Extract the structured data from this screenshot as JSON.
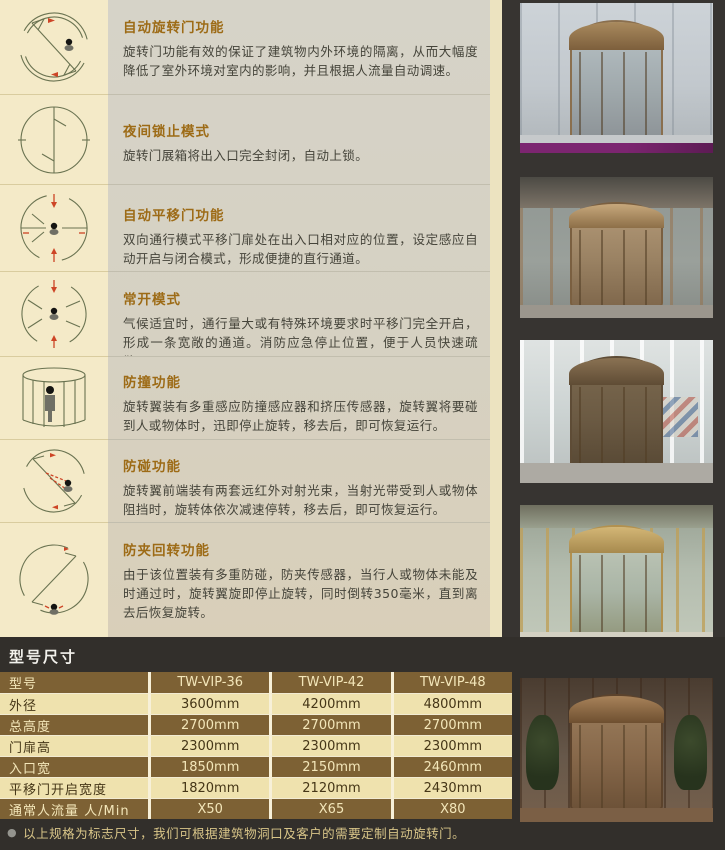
{
  "sections": [
    {
      "title": "自动旋转门功能",
      "body": "旋转门功能有效的保证了建筑物内外环境的隔离，从而大幅度降低了室外环境对室内的影响，并且根据人流量自动调速。",
      "diagram": "auto-revolving-top-view"
    },
    {
      "title": "夜间锁止模式",
      "body": "旋转门展箱将出入口完全封闭，自动上锁。",
      "diagram": "night-lock-top-view"
    },
    {
      "title": "自动平移门功能",
      "body": "双向通行模式平移门扉处在出入口相对应的位置，设定感应自动开启与闭合模式，形成便捷的直行通道。",
      "diagram": "auto-sliding-top-view"
    },
    {
      "title": "常开模式",
      "body": "气候适宜时，通行量大或有特殊环境要求时平移门完全开启，形成一条宽敞的通道。消防应急停止位置，便于人员快速疏散。",
      "diagram": "always-open-top-view"
    },
    {
      "title": "防撞功能",
      "body": "旋转翼装有多重感应防撞感应器和挤压传感器，旋转翼将要碰到人或物体时，迅即停止旋转，移去后，即可恢复运行。",
      "diagram": "anti-collision-elevation-view"
    },
    {
      "title": "防碰功能",
      "body": "旋转翼前端装有两套远红外对射光束，当射光带受到人或物体阻挡时，旋转体依次减速停转，移去后，即可恢复运行。",
      "diagram": "infrared-beam-top-view"
    },
    {
      "title": "防夹回转功能",
      "body": "由于该位置装有多重防碰，防夹传感器，当行人或物体未能及时通过时，旋转翼旋即停止旋转，同时倒转350毫米，直到离去后恢复旋转。",
      "diagram": "anti-pinch-reverse-top-view"
    }
  ],
  "spec": {
    "title": "型号尺寸",
    "table": {
      "headers": [
        "型号",
        "TW-VIP-36",
        "TW-VIP-42",
        "TW-VIP-48"
      ],
      "rows": [
        {
          "label": "外径",
          "values": [
            "3600mm",
            "4200mm",
            "4800mm"
          ]
        },
        {
          "label": "总高度",
          "values": [
            "2700mm",
            "2700mm",
            "2700mm"
          ]
        },
        {
          "label": "门扉高",
          "values": [
            "2300mm",
            "2300mm",
            "2300mm"
          ]
        },
        {
          "label": "入口宽",
          "values": [
            "1850mm",
            "2150mm",
            "2460mm"
          ]
        },
        {
          "label": "平移门开启宽度",
          "values": [
            "1820mm",
            "2120mm",
            "2430mm"
          ]
        },
        {
          "label": "通常人流量 人/Min",
          "values": [
            "X50",
            "X65",
            "X80"
          ]
        }
      ]
    },
    "note_bullet": "●",
    "note": "以上规格为标志尺寸，我们可根据建筑物洞口及客户的需要定制自动旋转门。"
  },
  "photos": [
    "revolving-door-photo-1",
    "revolving-door-photo-2",
    "revolving-door-photo-3",
    "revolving-door-photo-4",
    "revolving-door-photo-5"
  ],
  "colors": {
    "page_cream": "#f4eac8",
    "panel_gray": "#d6d1c2",
    "dark_band": "#322f2b",
    "heading_accent": "#9d6b16",
    "table_brown": "#7d6134",
    "table_cream": "#efe2ae",
    "note_gold": "#d8c588",
    "diagram_line_olive": "#6a7351",
    "diagram_red": "#cd4526"
  }
}
